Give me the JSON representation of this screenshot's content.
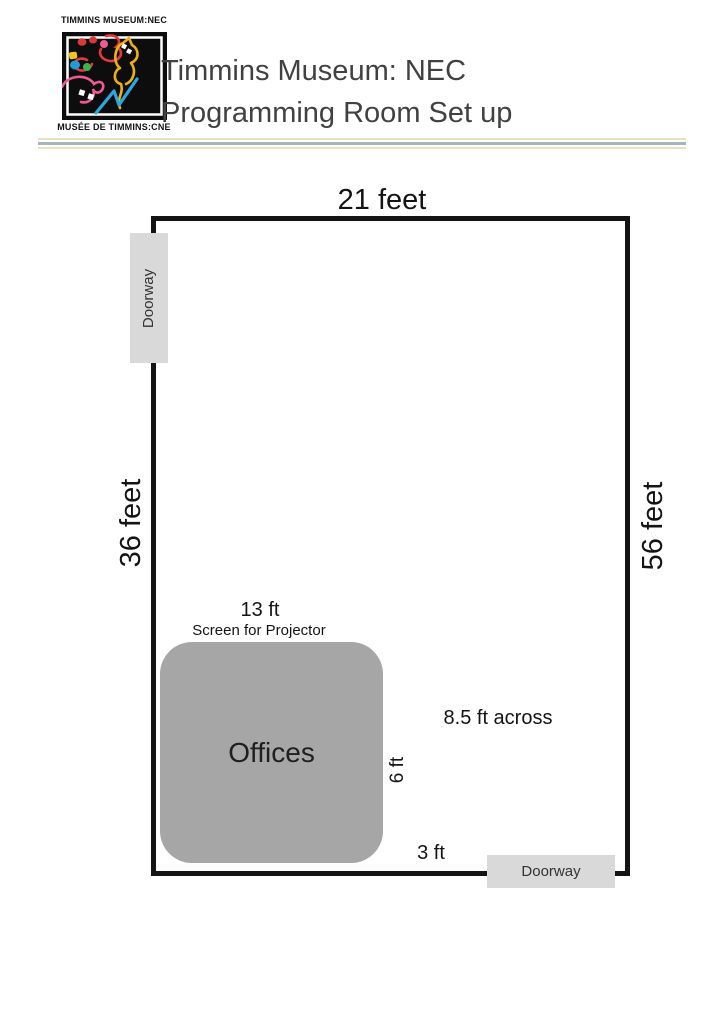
{
  "header": {
    "logo": {
      "top_text": "TIMMINS MUSEUM:NEC",
      "bottom_text": "MUSÉE DE TIMMINS:CNE"
    },
    "title_line1": "Timmins Museum: NEC",
    "title_line2": "Programming Room Set up"
  },
  "floor_plan": {
    "room": {
      "top_wall_label": "21 feet",
      "left_wall_label": "36 feet",
      "right_wall_label": "56 feet"
    },
    "doorways": {
      "left_wall": "Doorway",
      "bottom_wall": "Doorway"
    },
    "offices": {
      "label": "Offices",
      "top_width_label": "13 ft",
      "screen_label": "Screen for Projector",
      "side_height_label": "6 ft"
    },
    "clearances": {
      "right_of_offices": "8.5 ft across",
      "below_offices": "3 ft"
    }
  },
  "colors": {
    "wall": "#141414",
    "offices_fill": "#a6a6a6",
    "doorway_fill": "#d9d9d9",
    "divider_yellow": "#e9e2bc",
    "divider_blue": "#a2b6bd",
    "title_text": "#414141"
  }
}
